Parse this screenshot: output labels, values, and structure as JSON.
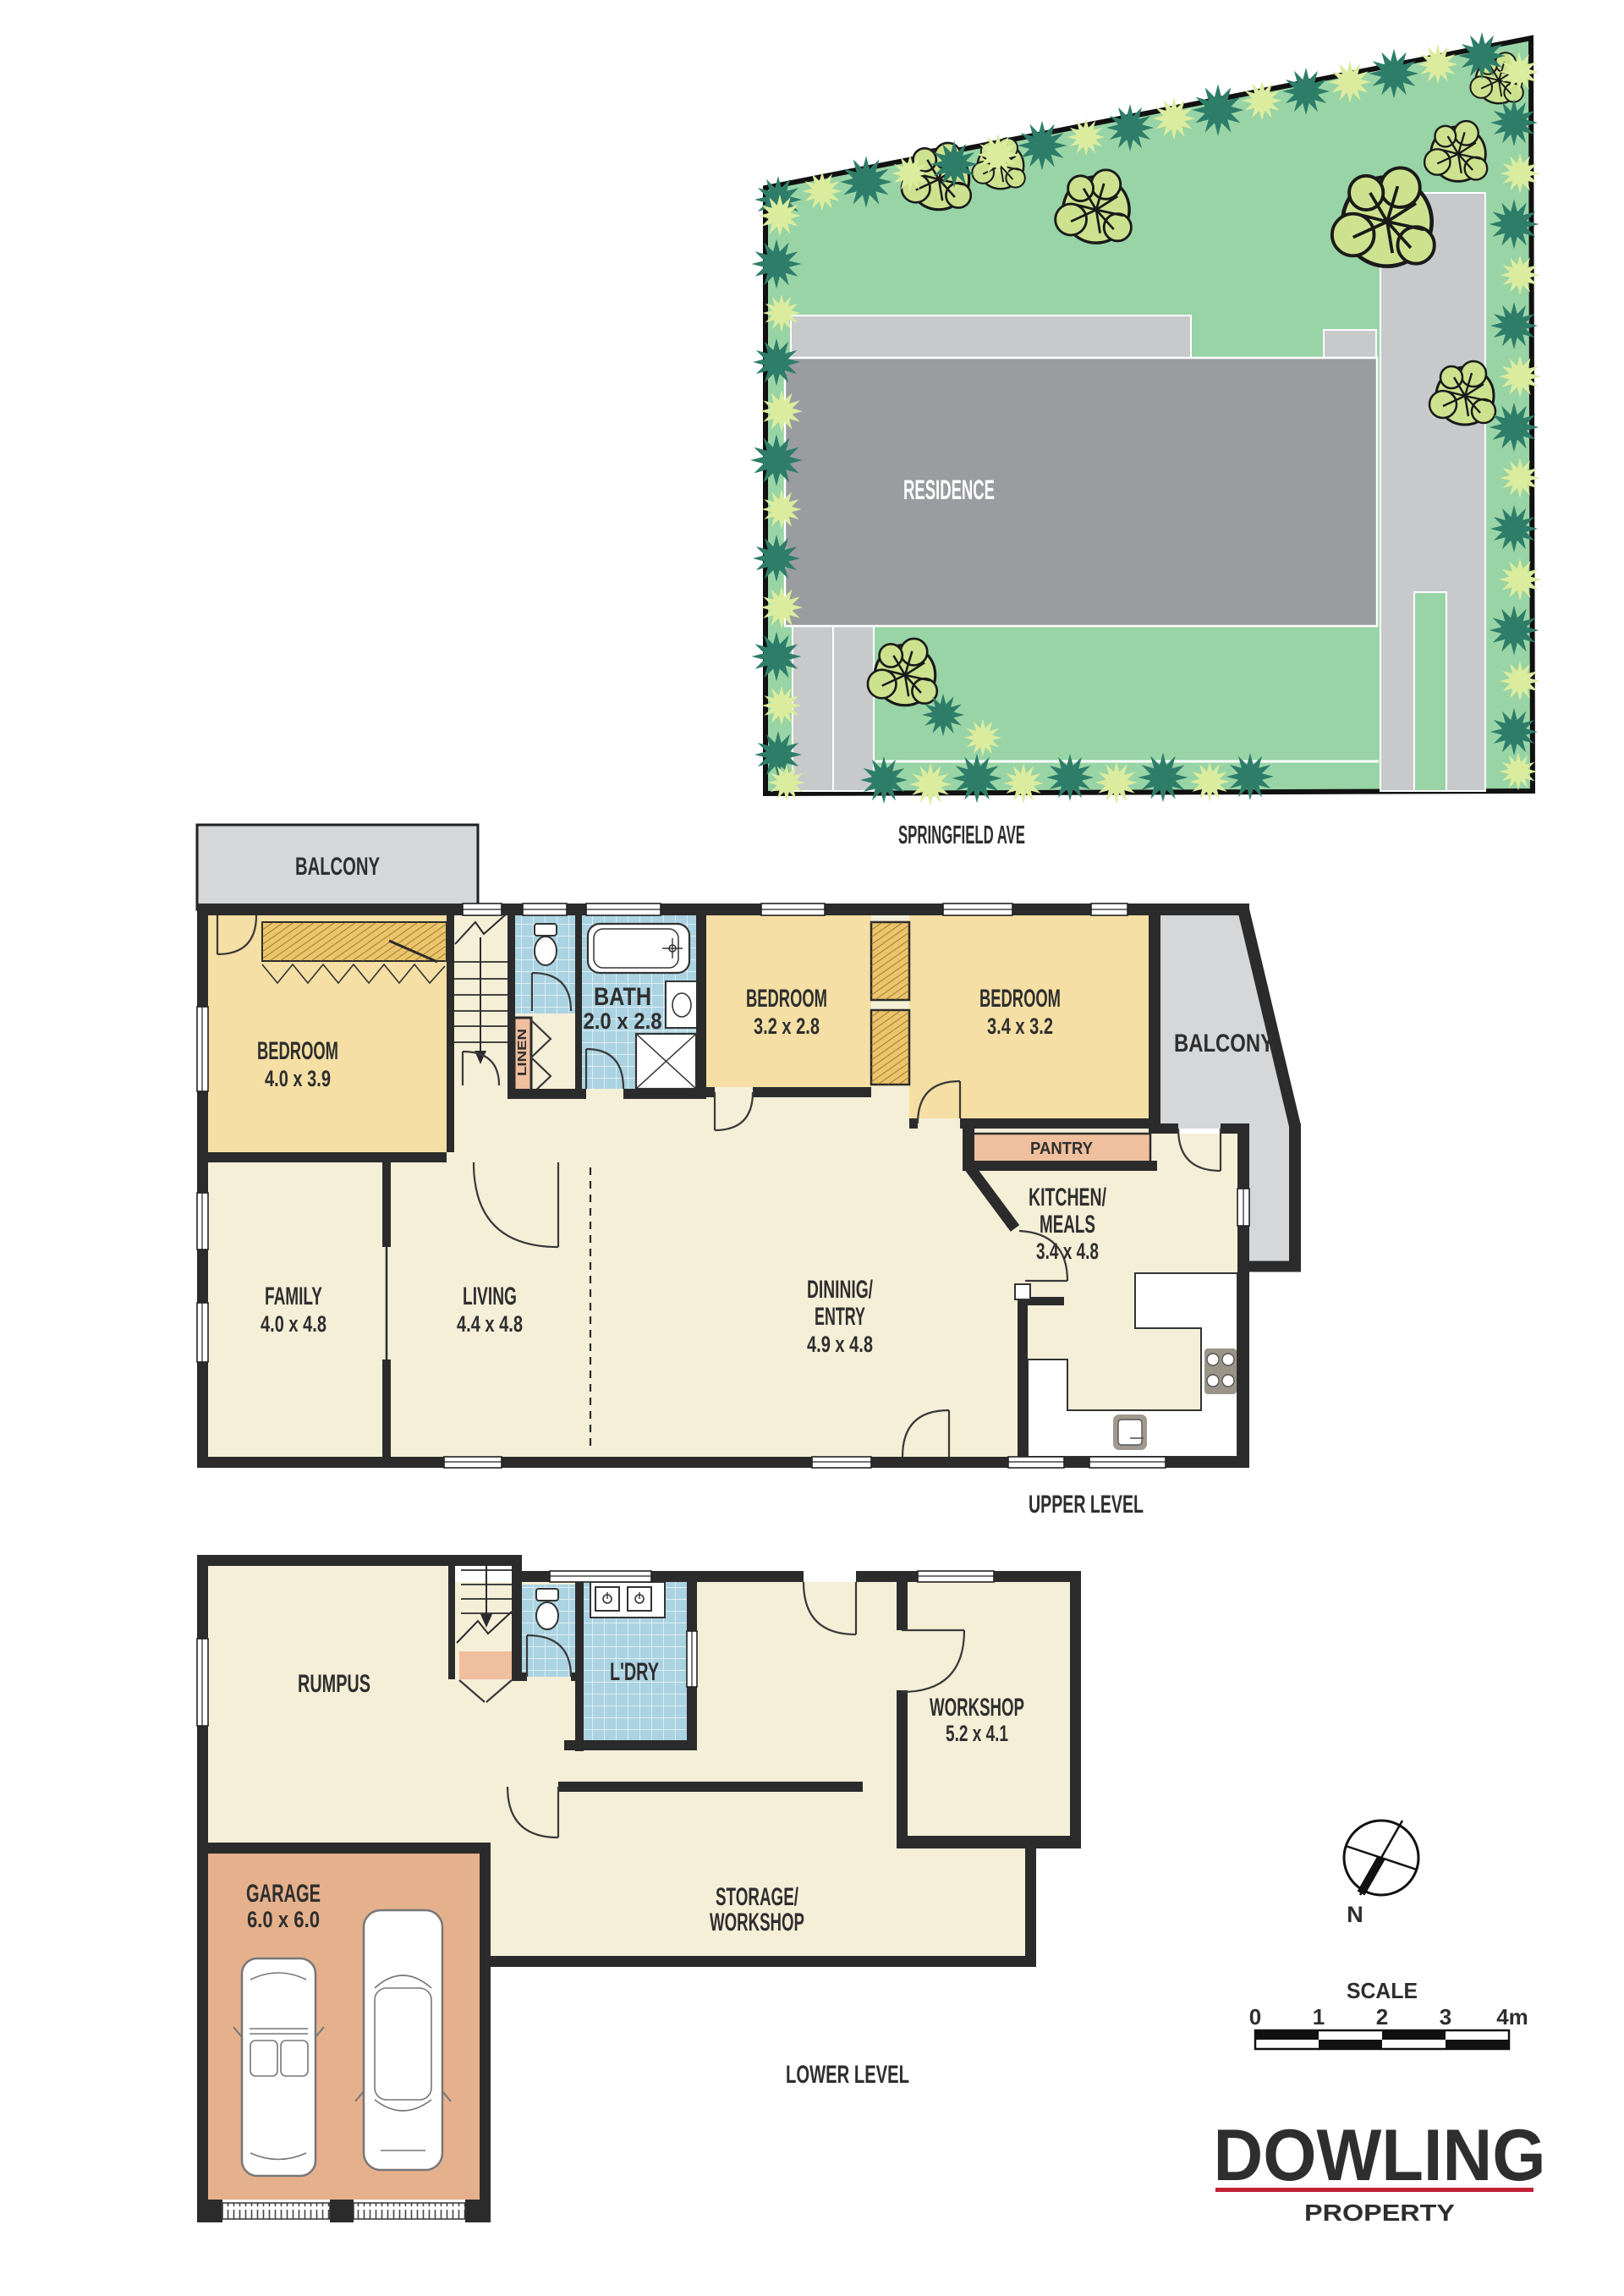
{
  "site_plan": {
    "residence_label": "RESIDENCE",
    "street_label": "SPRINGFIELD AVE",
    "colors": {
      "grass": "#98d4a6",
      "building": "#9a9c9f",
      "paving": "#c7c9cb",
      "tree": "#cde28e",
      "shrub_dark": "#2e7d69",
      "shrub_light": "#dcec9e"
    }
  },
  "upper_level": {
    "title": "UPPER LEVEL",
    "balcony_left": "BALCONY",
    "balcony_right": "BALCONY",
    "bedroom1": {
      "name": "BEDROOM",
      "dims": "4.0 x 3.9"
    },
    "bath": {
      "name": "BATH",
      "dims": "2.0 x 2.8"
    },
    "bedroom2": {
      "name": "BEDROOM",
      "dims": "3.2 x 2.8"
    },
    "bedroom3": {
      "name": "BEDROOM",
      "dims": "3.4 x 3.2"
    },
    "linen": "LINEN",
    "pantry": "PANTRY",
    "kitchen": {
      "name1": "KITCHEN/",
      "name2": "MEALS",
      "dims": "3.4 x 4.8"
    },
    "family": {
      "name": "FAMILY",
      "dims": "4.0 x 4.8"
    },
    "living": {
      "name": "LIVING",
      "dims": "4.4 x 4.8"
    },
    "dining": {
      "name1": "DININIG/",
      "name2": "ENTRY",
      "dims": "4.9 x 4.8"
    }
  },
  "lower_level": {
    "title": "LOWER LEVEL",
    "rumpus": "RUMPUS",
    "laundry": "L'DRY",
    "workshop": {
      "name": "WORKSHOP",
      "dims": "5.2 x 4.1"
    },
    "garage": {
      "name": "GARAGE",
      "dims": "6.0 x 6.0"
    },
    "storage": {
      "name1": "STORAGE/",
      "name2": "WORKSHOP"
    }
  },
  "compass": {
    "north_label": "N"
  },
  "scale_bar": {
    "title": "SCALE",
    "ticks": [
      "0",
      "1",
      "2",
      "3",
      "4m"
    ]
  },
  "logo": {
    "brand": "DOWLING",
    "tagline": "PROPERTY",
    "brand_color": "#21387b",
    "line_color": "#c22135"
  }
}
